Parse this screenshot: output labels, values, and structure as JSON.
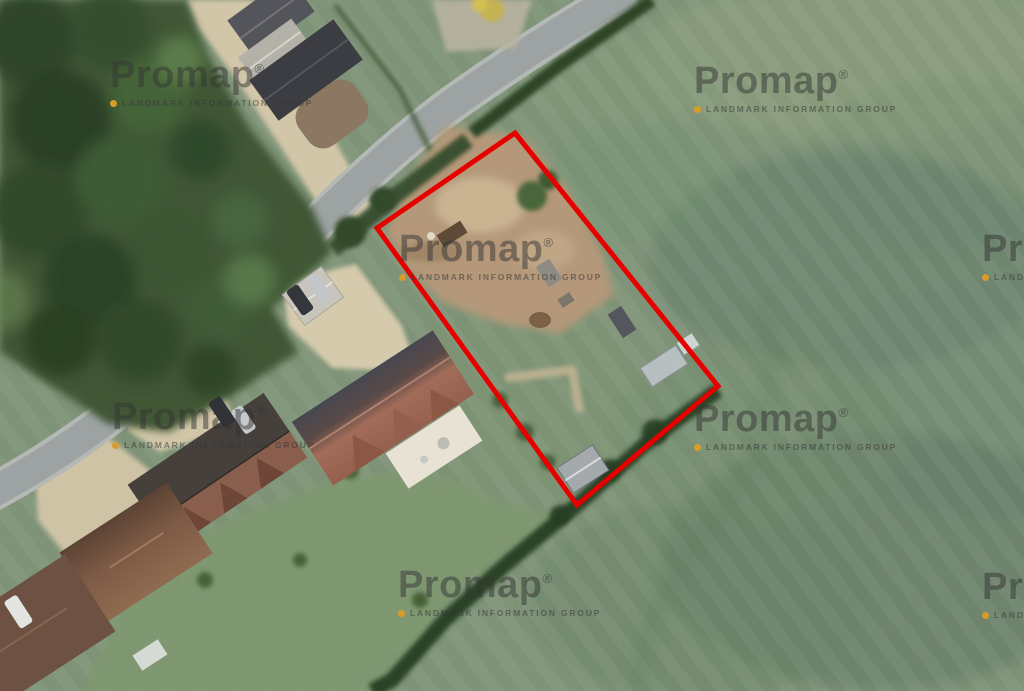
{
  "watermark": {
    "brand": "Promap",
    "registered": "®",
    "subtitle": "LANDMARK INFORMATION GROUP",
    "dot_color": "#d99b2a",
    "text_color": "#343434"
  },
  "boundary": {
    "shape": "quadrilateral site outline",
    "points": "515,133 718,386 577,505 377,228",
    "color": "#e60000",
    "stroke_width": 5
  },
  "palette": {
    "field_green": "#7e9377",
    "woodland_green": "#3f5636",
    "hedge_green": "#2e4428",
    "road_gray": "#9da3a2",
    "driveway_beige": "#d2c6a8",
    "bare_earth_tan": "#b49879",
    "roof_terracotta": "#a26c59",
    "roof_dark_slate": "#3c3d43",
    "roof_brown": "#7b5a47",
    "shed_gray": "#a3a9ad"
  }
}
